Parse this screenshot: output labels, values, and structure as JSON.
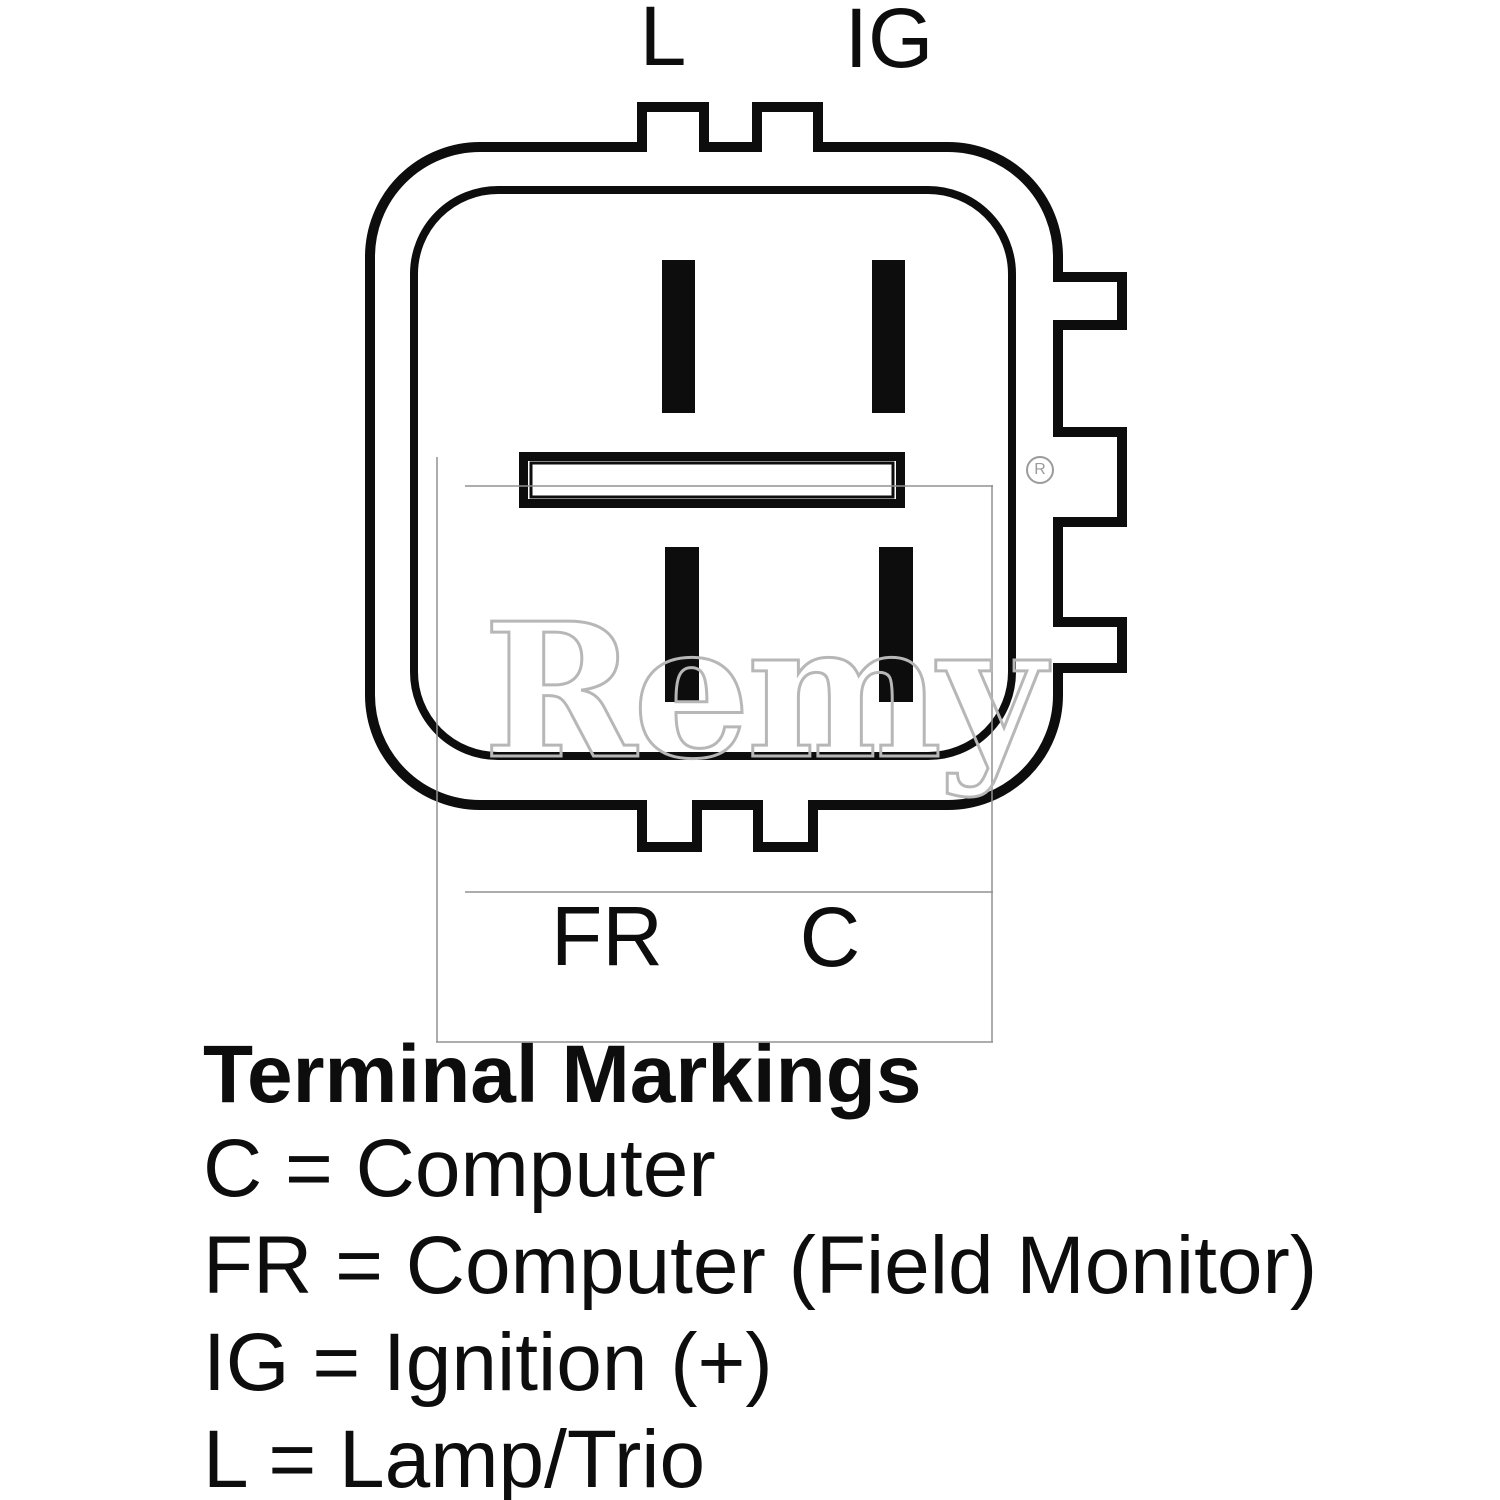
{
  "figure": {
    "top_labels": {
      "left": "L",
      "right": "IG"
    },
    "bottom_labels": {
      "left": "FR",
      "right": "C"
    },
    "watermark": {
      "brand": "Remy",
      "registered_mark": "R"
    },
    "colors": {
      "line": "#0d0d0d",
      "watermark_gray": "#b7b7b7",
      "background": "#ffffff"
    }
  },
  "legend": {
    "title": "Terminal Markings",
    "entries": [
      "C = Computer",
      "FR = Computer (Field Monitor)",
      "IG = Ignition (+)",
      "L = Lamp/Trio"
    ]
  }
}
